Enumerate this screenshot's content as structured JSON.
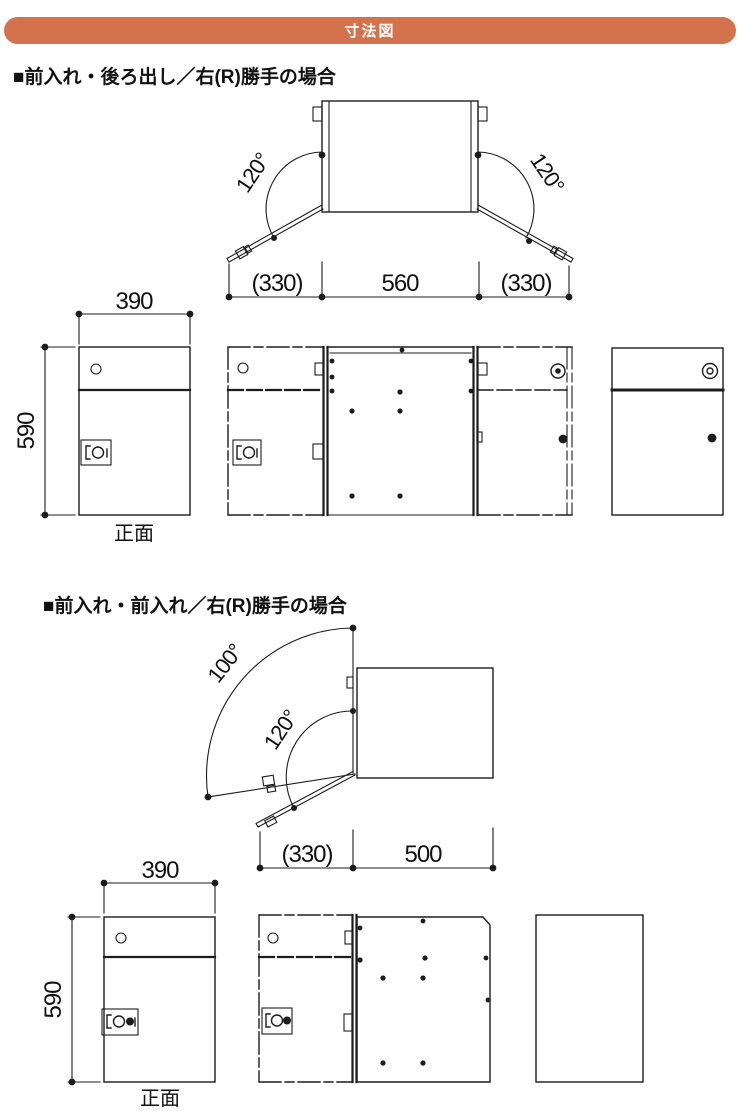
{
  "page": {
    "background": "#ffffff",
    "line_color": "#1c1c1c"
  },
  "header": {
    "title": "寸法図",
    "bar_color": "#d3734e",
    "text_color": "#ffffff"
  },
  "sections": [
    {
      "heading": "■前入れ・後ろ出し／右(R)勝手の場合",
      "plan": {
        "angle_left": "120°",
        "angle_right": "120°",
        "dim_left": "(330)",
        "dim_center": "560",
        "dim_right": "(330)"
      },
      "front": {
        "width_label": "390",
        "height_label": "590",
        "caption": "正面"
      }
    },
    {
      "heading": "■前入れ・前入れ／右(R)勝手の場合",
      "plan": {
        "angle_outer": "100°",
        "angle_inner": "120°",
        "dim_left": "(330)",
        "dim_right": "500"
      },
      "front": {
        "width_label": "390",
        "height_label": "590",
        "caption": "正面"
      }
    }
  ]
}
